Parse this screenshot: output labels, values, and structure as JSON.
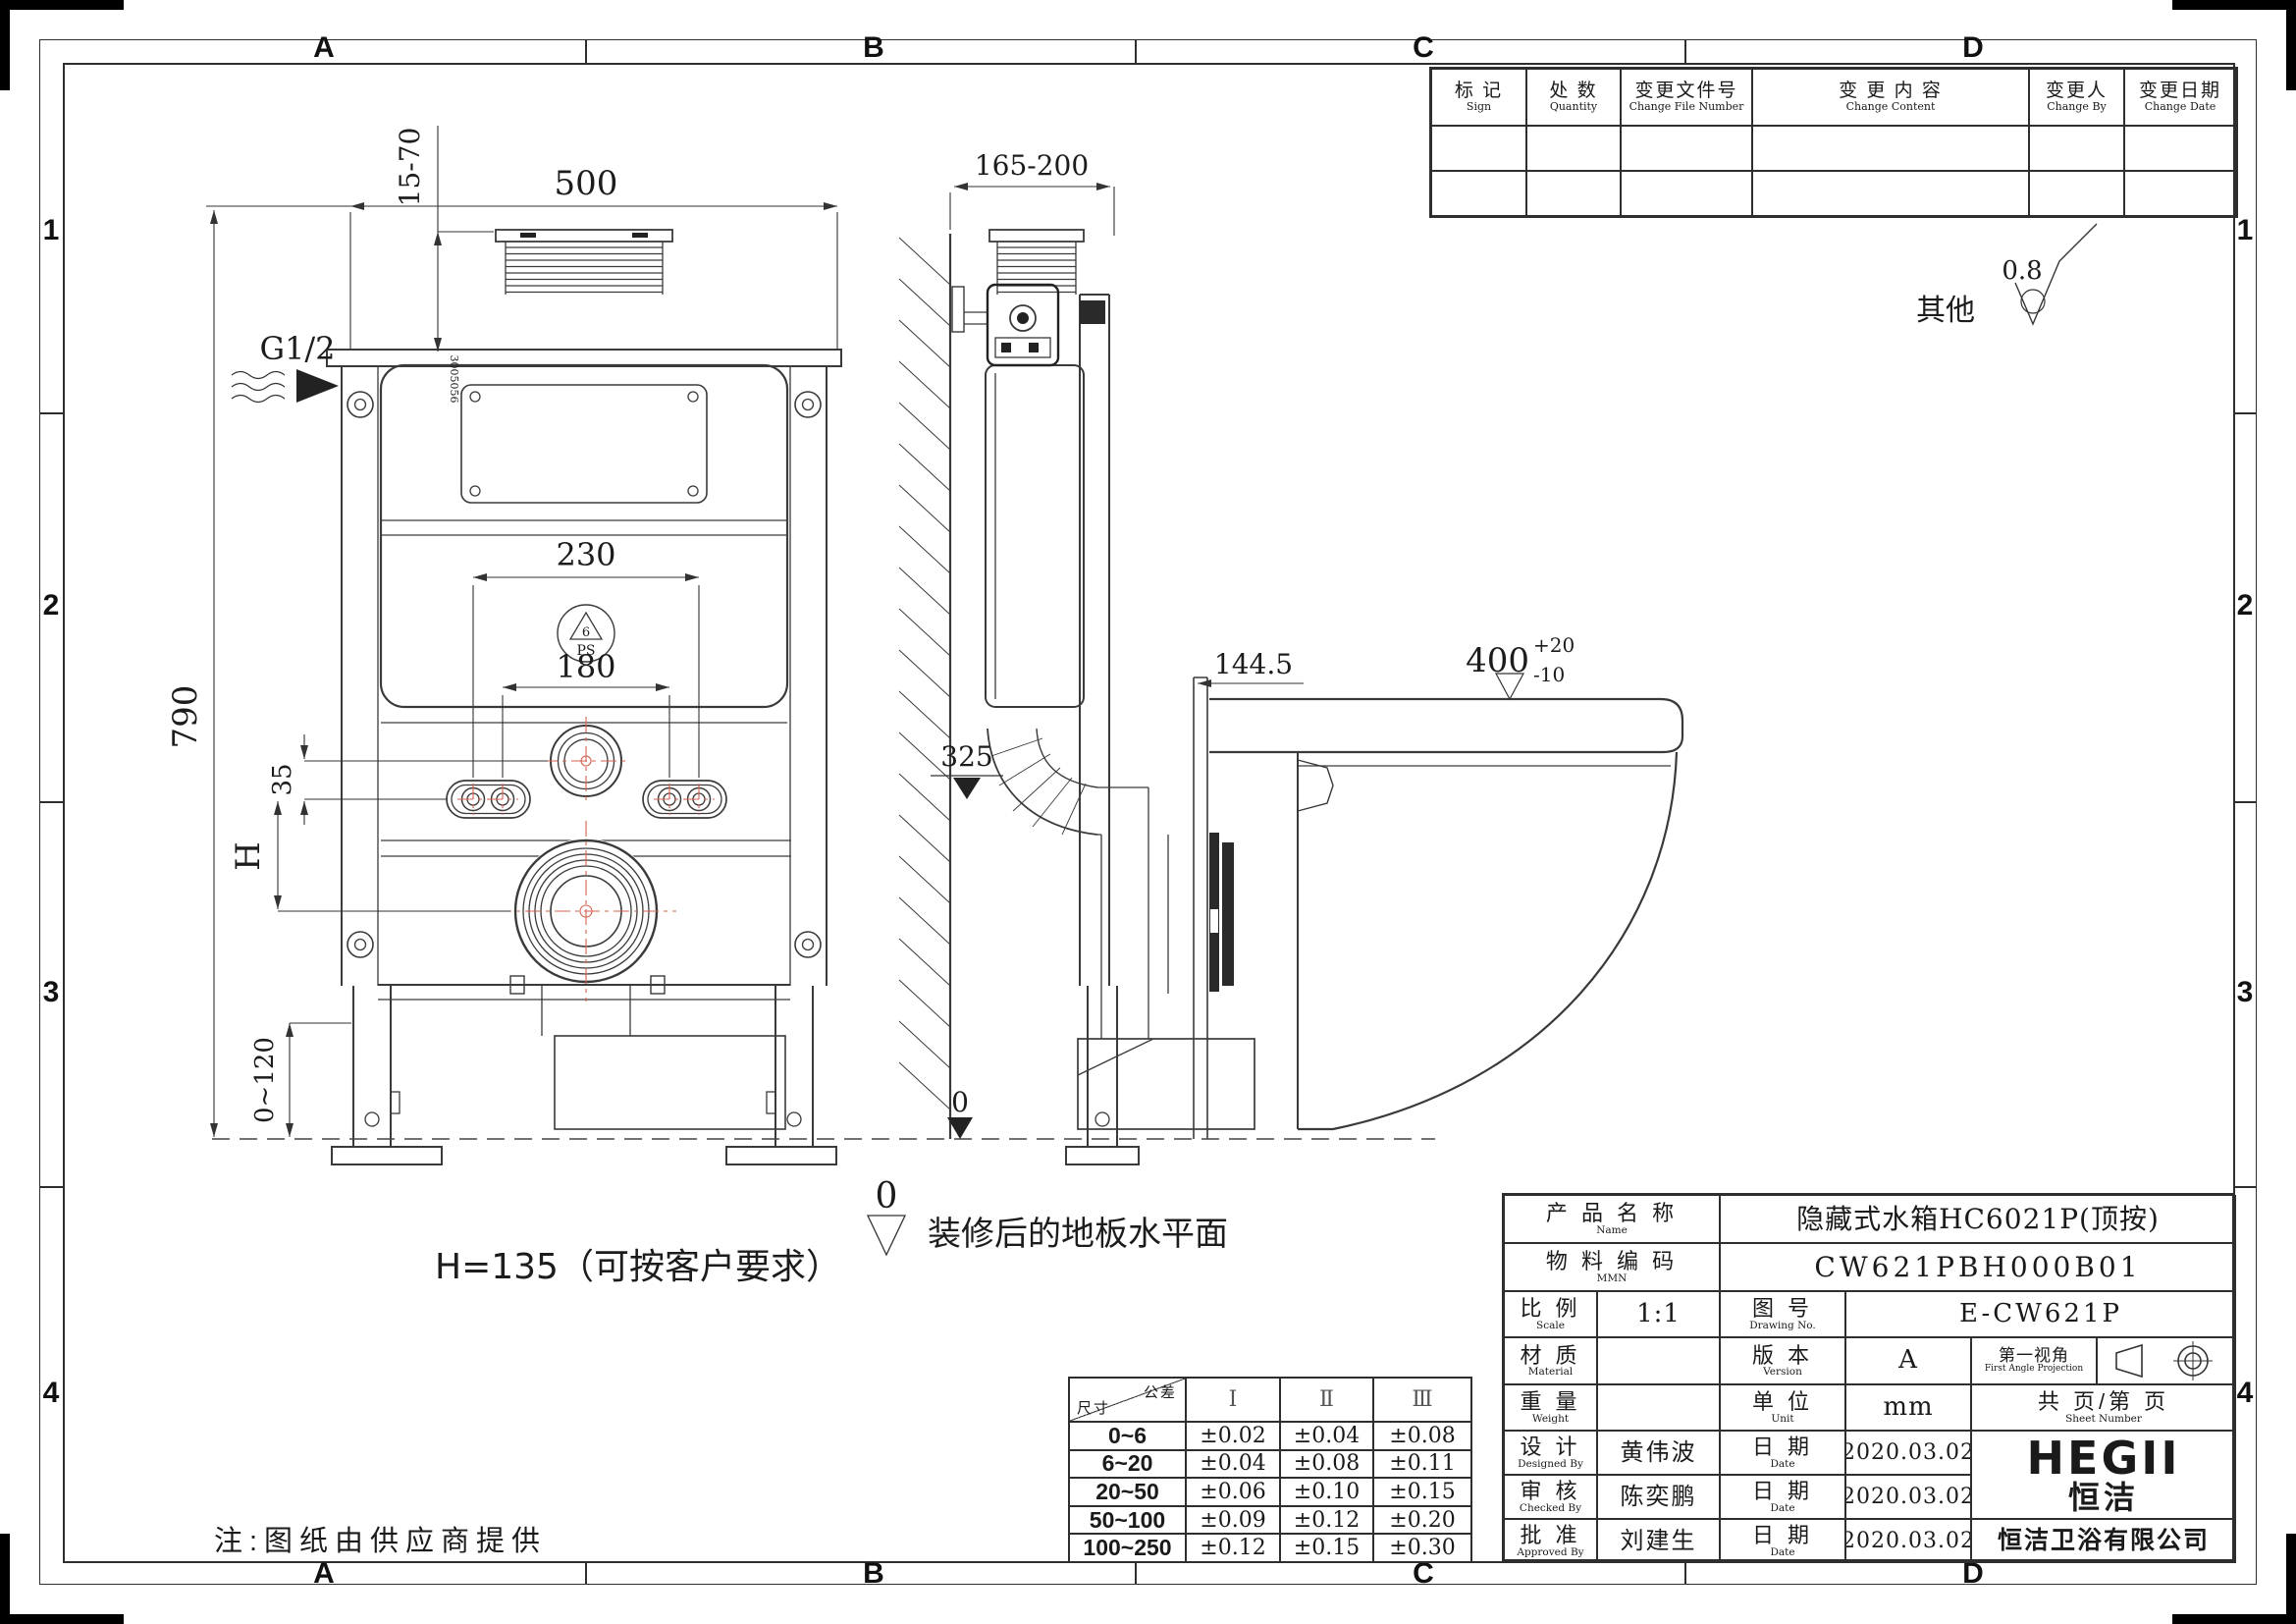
{
  "colors": {
    "line": "#3a3a3a",
    "centerline_red": "#d4604f",
    "black_fill": "#222222"
  },
  "border": {
    "top_letters": [
      "A",
      "B",
      "C",
      "D"
    ],
    "bottom_letters": [
      "A",
      "B",
      "C",
      "D"
    ],
    "left_numbers": [
      "1",
      "2",
      "3",
      "4"
    ],
    "right_numbers": [
      "1",
      "2",
      "3",
      "4"
    ]
  },
  "revision_table": {
    "headers": [
      {
        "cn": "标 记",
        "en": "Sign"
      },
      {
        "cn": "处 数",
        "en": "Quantity"
      },
      {
        "cn": "变更文件号",
        "en": "Change File Number"
      },
      {
        "cn": "变 更 内 容",
        "en": "Change Content"
      },
      {
        "cn": "变更人",
        "en": "Change By"
      },
      {
        "cn": "变更日期",
        "en": "Change Date"
      }
    ],
    "rows": [
      [
        "",
        "",
        "",
        "",
        "",
        ""
      ],
      [
        "",
        "",
        "",
        "",
        "",
        ""
      ]
    ]
  },
  "tolerance_table": {
    "corner": {
      "top": "公差",
      "bottom": "尺寸"
    },
    "columns": [
      "Ⅰ",
      "Ⅱ",
      "Ⅲ"
    ],
    "rows": [
      {
        "range": "0~6",
        "values": [
          "±0.02",
          "±0.04",
          "±0.08"
        ]
      },
      {
        "range": "6~20",
        "values": [
          "±0.04",
          "±0.08",
          "±0.11"
        ]
      },
      {
        "range": "20~50",
        "values": [
          "±0.06",
          "±0.10",
          "±0.15"
        ]
      },
      {
        "range": "50~100",
        "values": [
          "±0.09",
          "±0.12",
          "±0.20"
        ]
      },
      {
        "range": "100~250",
        "values": [
          "±0.12",
          "±0.15",
          "±0.30"
        ]
      }
    ]
  },
  "title_block": {
    "labels": {
      "product": {
        "cn": "产 品 名 称",
        "en": "Name"
      },
      "mmn": {
        "cn": "物 料 编 码",
        "en": "MMN"
      },
      "scale": {
        "cn": "比 例",
        "en": "Scale"
      },
      "drawing_no": {
        "cn": "图 号",
        "en": "Drawing No."
      },
      "material": {
        "cn": "材 质",
        "en": "Material"
      },
      "version": {
        "cn": "版 本",
        "en": "Version"
      },
      "projection": {
        "cn": "第一视角",
        "en": "First Angle Projection"
      },
      "weight": {
        "cn": "重 量",
        "en": "Weight"
      },
      "unit": {
        "cn": "单 位",
        "en": "Unit"
      },
      "sheet": {
        "cn": "共  页/第  页",
        "en": "Sheet Number"
      },
      "design": {
        "cn": "设 计",
        "en": "Designed By"
      },
      "check": {
        "cn": "审 核",
        "en": "Checked By"
      },
      "approve": {
        "cn": "批 准",
        "en": "Approved By"
      },
      "date": {
        "cn": "日 期",
        "en": "Date"
      }
    },
    "values": {
      "product": "隐藏式水箱HC6021P(顶按)",
      "mmn": "CW621PBH000B01",
      "scale": "1:1",
      "drawing_no": "E-CW621P",
      "material": "",
      "version": "A",
      "weight": "",
      "unit": "mm",
      "designer": "黄伟波",
      "design_date": "2020.03.02",
      "checker": "陈奕鹏",
      "check_date": "2020.03.02",
      "approver": "刘建生",
      "approve_date": "2020.03.02"
    },
    "logo": {
      "en": "HEGII",
      "cn": "恒洁",
      "company": "恒洁卫浴有限公司"
    }
  },
  "drawing": {
    "dims": {
      "width": "500",
      "top_offset": "15-70",
      "inlet": "G1/2",
      "bolt_outer": "230",
      "bolt_inner": "180",
      "height": "790",
      "offset35": "35",
      "h_label": "H",
      "leg_adjust": "0~120",
      "inlet_height": "325",
      "floor_zero": "0",
      "depth": "165-200",
      "wall_offset": "144.5",
      "seat_height": "400",
      "seat_tol_plus": "+20",
      "seat_tol_minus": "-10",
      "datum_zero": "0"
    },
    "symbols": {
      "ps": "PS",
      "ps_num": "6",
      "part_number": "3005056",
      "surface_value": "0.8",
      "surface_label": "其他"
    },
    "notes": {
      "h_note": "H=135（可按客户要求）",
      "floor_note": "装修后的地板水平面",
      "supplier_note": "注:图纸由供应商提供"
    }
  }
}
